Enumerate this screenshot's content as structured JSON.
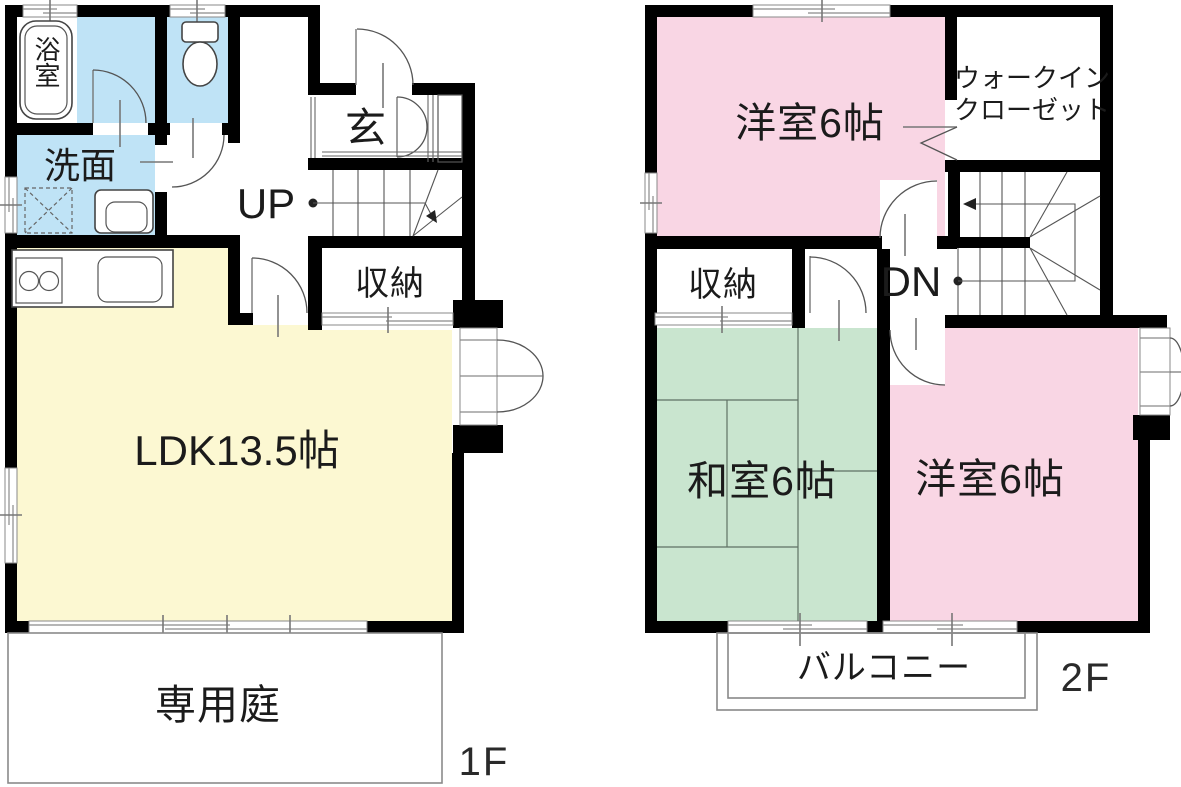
{
  "colors": {
    "wall": "#000000",
    "water": "#bfe3f6",
    "ldk": "#fcf8d2",
    "bedroom": "#f9d6e4",
    "tatami": "#c9e5cf"
  },
  "floor1": {
    "floor_label": "1F",
    "bath": "浴室",
    "washroom": "洗面",
    "entrance": "玄",
    "stairs_up": "UP",
    "storage": "収納",
    "ldk": "LDK13.5帖",
    "garden": "専用庭"
  },
  "floor2": {
    "floor_label": "2F",
    "bedroom_top": "洋室6帖",
    "wic_line1": "ウォークイン",
    "wic_line2": "クローゼット",
    "storage": "収納",
    "stairs_down": "DN",
    "tatami_room": "和室6帖",
    "bedroom_bottom": "洋室6帖",
    "balcony": "バルコニー"
  }
}
